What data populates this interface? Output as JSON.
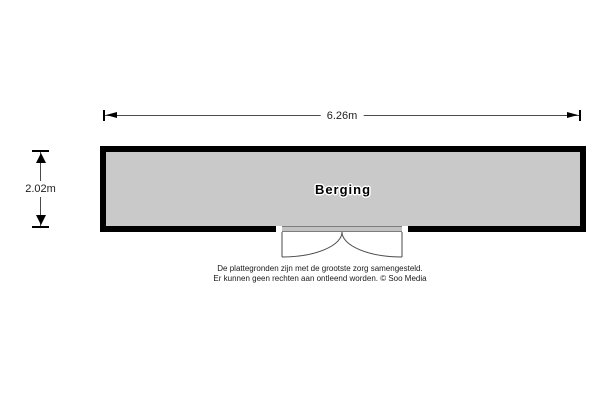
{
  "floorplan": {
    "room": {
      "label": "Berging",
      "fill_color": "#c9c9c9",
      "wall_color": "#000000"
    },
    "dimensions": {
      "width_label": "6.26m",
      "height_label": "2.02m"
    },
    "door": {
      "icon": "double-swing-door-icon"
    }
  },
  "disclaimer": {
    "line1": "De plattegronden zijn met de grootste zorg samengesteld.",
    "line2": "Er kunnen geen rechten aan ontleend worden. © Soo Media"
  }
}
